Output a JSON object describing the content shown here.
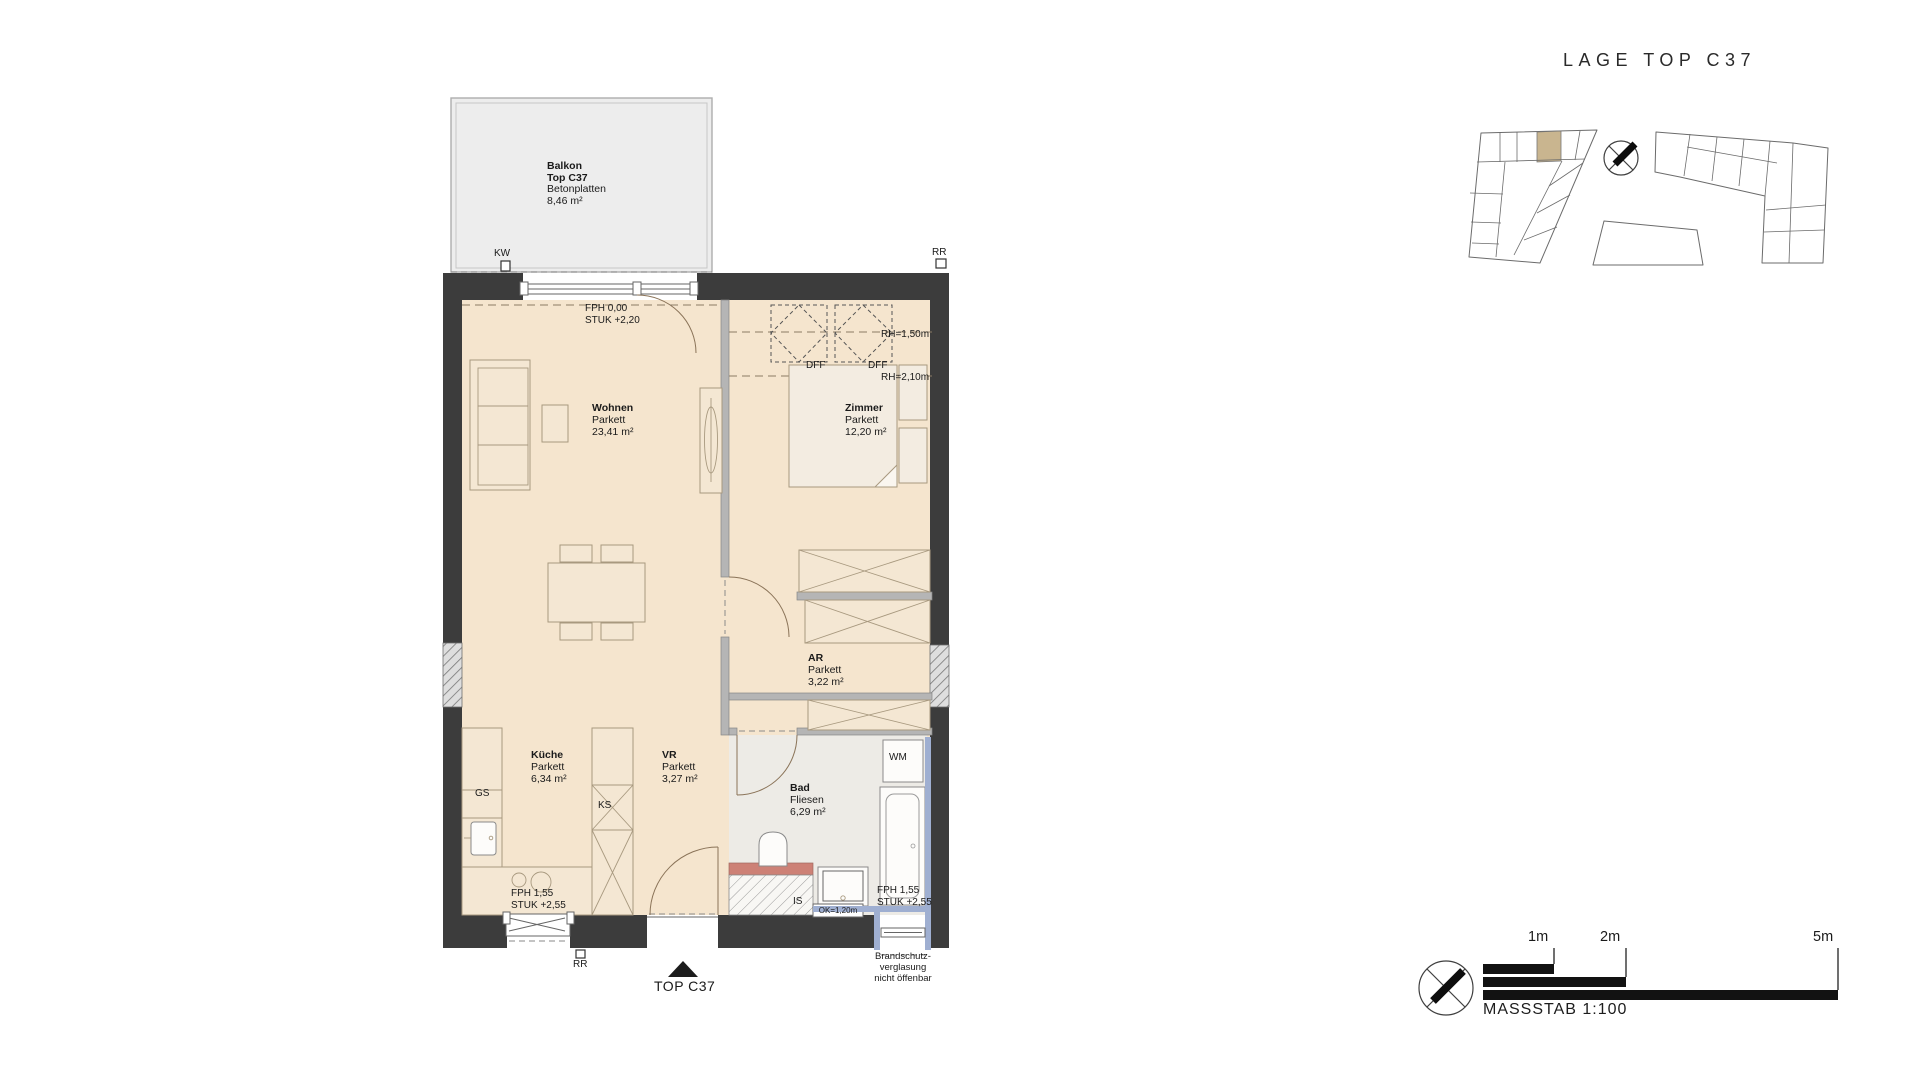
{
  "header": {
    "title": "LAGE TOP C37"
  },
  "floorplan": {
    "balcony": {
      "name": "Balkon",
      "unit": "Top C37",
      "surface": "Betonplatten",
      "area": "8,46 m²"
    },
    "rooms": {
      "wohnen": {
        "name": "Wohnen",
        "floor": "Parkett",
        "area": "23,41 m²"
      },
      "zimmer": {
        "name": "Zimmer",
        "floor": "Parkett",
        "area": "12,20 m²"
      },
      "ar": {
        "name": "AR",
        "floor": "Parkett",
        "area": "3,22 m²"
      },
      "kueche": {
        "name": "Küche",
        "floor": "Parkett",
        "area": "6,34 m²"
      },
      "vr": {
        "name": "VR",
        "floor": "Parkett",
        "area": "3,27 m²"
      },
      "bad": {
        "name": "Bad",
        "floor": "Fliesen",
        "area": "6,29 m²"
      }
    },
    "levels": {
      "top": {
        "l1": "FPH 0,00",
        "l2": "STUK +2,20"
      },
      "bottom_left": {
        "l1": "FPH 1,55",
        "l2": "STUK +2,55"
      },
      "bottom_right": {
        "l1": "FPH 1,55",
        "l2": "STUK +2,55"
      }
    },
    "markers": {
      "kw": "KW",
      "rr_top": "RR",
      "rr_bottom": "RR",
      "gs": "GS",
      "ks": "KS",
      "wm": "WM",
      "is": "IS",
      "dff_left": "DFF",
      "dff_right": "DFF",
      "rh_upper": "RH=1,50m",
      "rh_lower": "RH=2,10m",
      "ok": "OK=1,20m"
    },
    "entrance": {
      "label": "TOP C37"
    },
    "fire_glazing_note": {
      "l1": "Brandschutz-",
      "l2": "verglasung",
      "l3": "nicht öffenbar"
    }
  },
  "scalebar": {
    "m1": "1m",
    "m2": "2m",
    "m5": "5m",
    "caption": "MASSSTAB 1:100"
  },
  "colors": {
    "ink": "#1a1a1a",
    "wall": "#3c3c3c",
    "floor": "#f5e5ce",
    "bad_floor": "#edebe6",
    "balcony": "#ededed",
    "interior_wall": "#b5b5b5",
    "furniture_line": "#a8997f",
    "furn_fill": "#f4e7d3",
    "glazing_blue": "#9fafd1",
    "red_strip": "#cd8176",
    "site_highlight": "#c9b58f"
  }
}
